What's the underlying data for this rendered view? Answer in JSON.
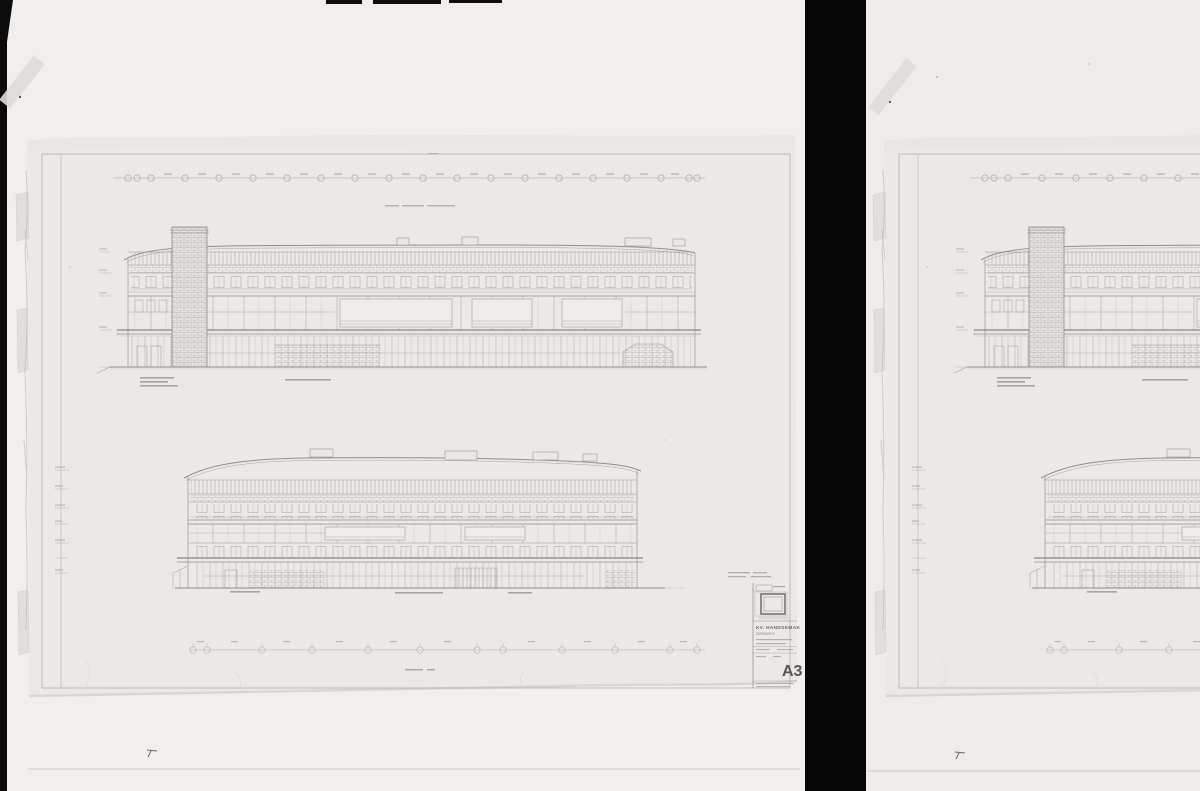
{
  "colors": {
    "film_background": "#0a0a0a",
    "film_gutter": "#070707",
    "frame_left": "#f0efed",
    "frame_right": "#edecea",
    "sheet_paper": "#ebe9e6",
    "pencil_line": "#a4a19b",
    "pencil_dark": "#8a8781",
    "ink_text": "#66635d"
  },
  "title_block": {
    "project": "KV. HANDSKMAK",
    "city": "ÖREBRO",
    "sheet_number": "A3"
  }
}
